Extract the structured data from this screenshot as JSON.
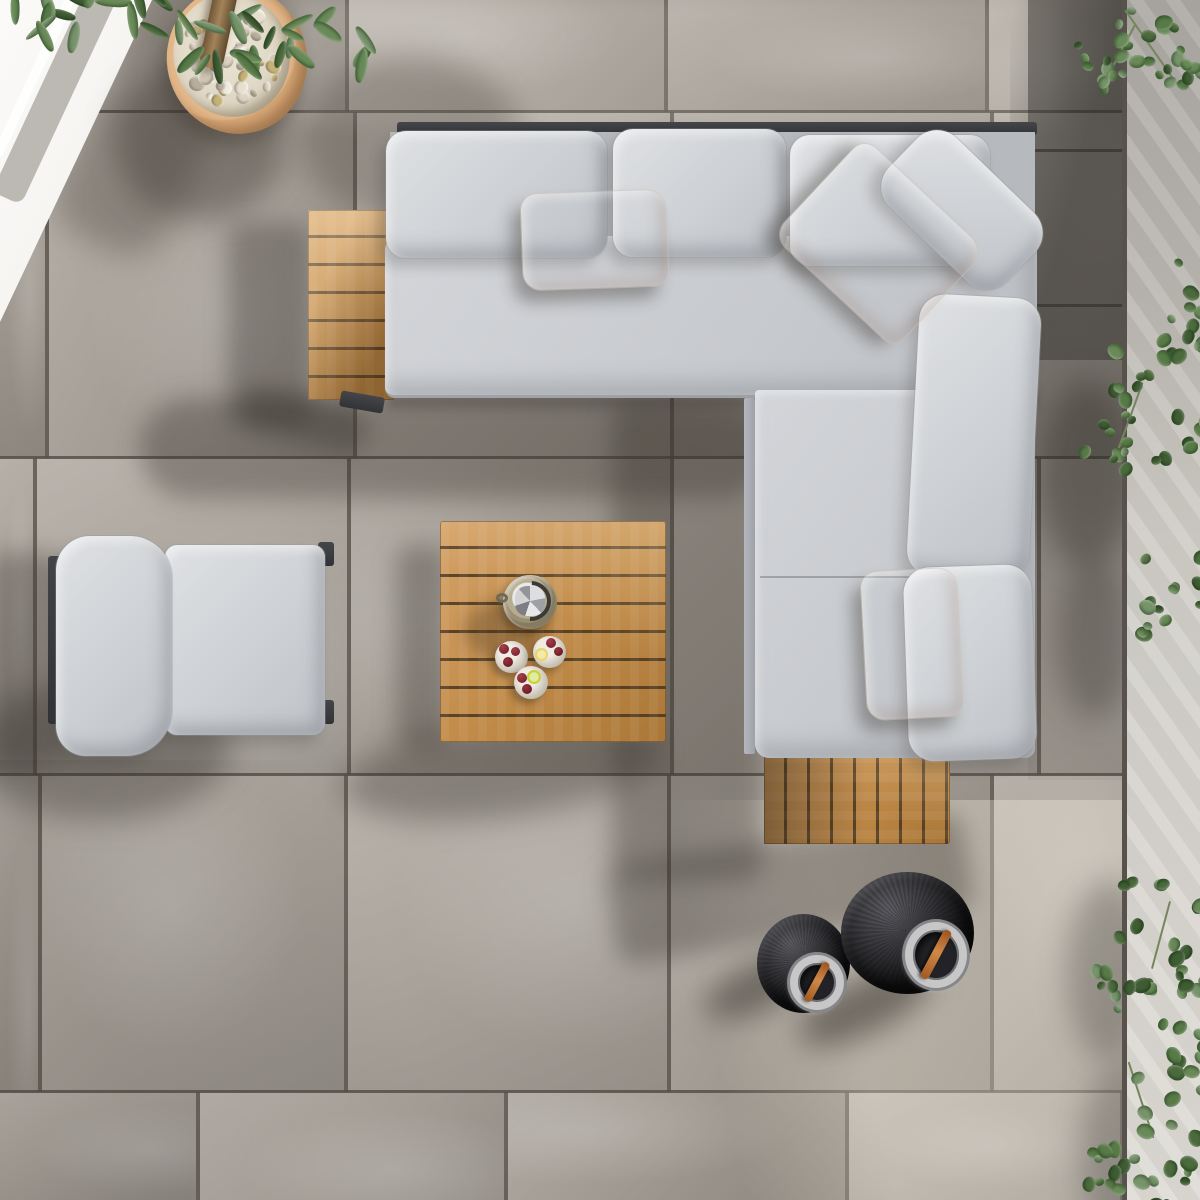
{
  "scene": {
    "description": "Top-down aerial view of an outdoor patio lounge set on grey stone porcelain paving",
    "objects": [
      "grey stone tile patio floor",
      "L-shaped corner sofa with light grey cushions and charcoal aluminium frame",
      "three multicolour striped scatter pillows",
      "teak slatted side table attached at sofa left end",
      "teak slatted side table attached at sofa bottom end",
      "square teak slatted coffee table",
      "single lounge armchair with light grey cushions",
      "woven ice bucket with ice",
      "three dessert glasses with cherries and citrus slices",
      "two black woven lanterns with steel rims and tan leather straps",
      "terracotta planter filled with white pebbles and a tree trunk",
      "green foliage top left",
      "ivy vines along right edge wall",
      "white rendered steps top left"
    ],
    "counts": {
      "striped_pillows": 3,
      "lanterns": 2,
      "drink_glasses": 3,
      "teak_tables": 3,
      "sofa_back_cushions": 6
    }
  },
  "palette": {
    "tile": "#a39d96",
    "grout": "#665f58",
    "cushion_light": "#dadce0",
    "cushion_mid": "#c3c6ca",
    "frame_charcoal": "#393b3e",
    "frame_aluminium": "#aaaeb4",
    "teak": "#c8905a",
    "teak_dark": "#a9763c",
    "pillow_base": "#f3eee6",
    "stripe_coral": "#e0796a",
    "stripe_salmon": "#efa38d",
    "stripe_blue": "#8cc0d2",
    "stripe_grey": "#99a1b6",
    "stripe_beige": "#c9b8a4",
    "lantern_black": "#141416",
    "lantern_steel": "#c6c7c6",
    "strap_orange": "#c06e36",
    "pot_terracotta": "#d8a877",
    "pebble_white": "#e9e2d2",
    "leaf_green": "#4c6b3d",
    "wall_white": "#f4f3f0",
    "wall_strip": "#cfccc6",
    "cherry_red": "#7e2230",
    "citrus_green": "#c8d23e",
    "citrus_yellow": "#e8d66a"
  }
}
